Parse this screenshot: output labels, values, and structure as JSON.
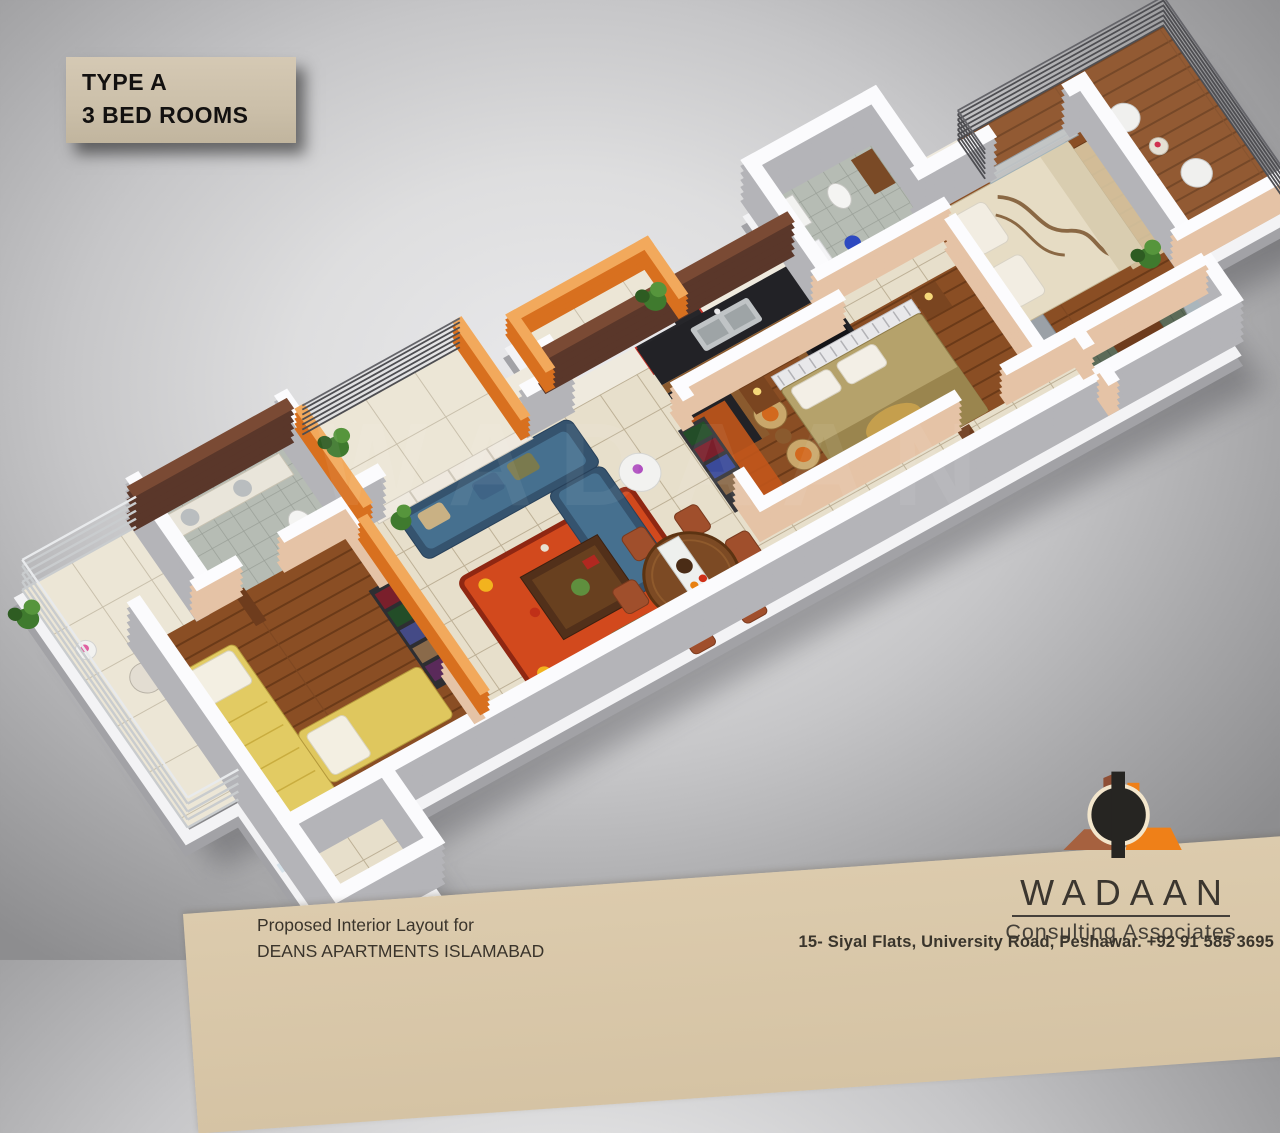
{
  "title": {
    "line1": "TYPE A",
    "line2": "3 BED ROOMS"
  },
  "caption": {
    "line1": "Proposed Interior Layout for",
    "line2": "DEANS APARTMENTS ISLAMABAD"
  },
  "brand": {
    "name": "WADAAN",
    "tagline": "Consulting Associates",
    "address": "15- Siyal Flats, University Road, Peshawar. +92 91 585 3695"
  },
  "watermark": "WADAAN",
  "plan": {
    "type": "3d-floor-plan",
    "rooms": [
      "bedroom-3",
      "bathroom-3",
      "balcony-left",
      "living-room",
      "balcony-living",
      "kitchen",
      "bathroom-2",
      "dining-area",
      "bedroom-2",
      "corridor",
      "walk-in-closet",
      "master-bedroom",
      "master-bathroom",
      "master-balcony",
      "entry-porch"
    ]
  },
  "colors": {
    "background_gray": "#c6c6c8",
    "band_beige": "#d8c6a8",
    "label_beige": "#cbbfa9",
    "wall_peach": "#e5c3a6",
    "wall_white_top": "#fbfbfd",
    "accent_orange": "#d8701f",
    "tile_floor": "#e7dfcb",
    "wood_floor": "#8a4e24",
    "sofa_blue": "#3f6486",
    "bed_yellow": "#e2cb63",
    "rug_orange": "#d2491d",
    "logo_orange": "#ef8018",
    "logo_brick": "#a6613f",
    "metal_railing": "#4e4e52"
  }
}
